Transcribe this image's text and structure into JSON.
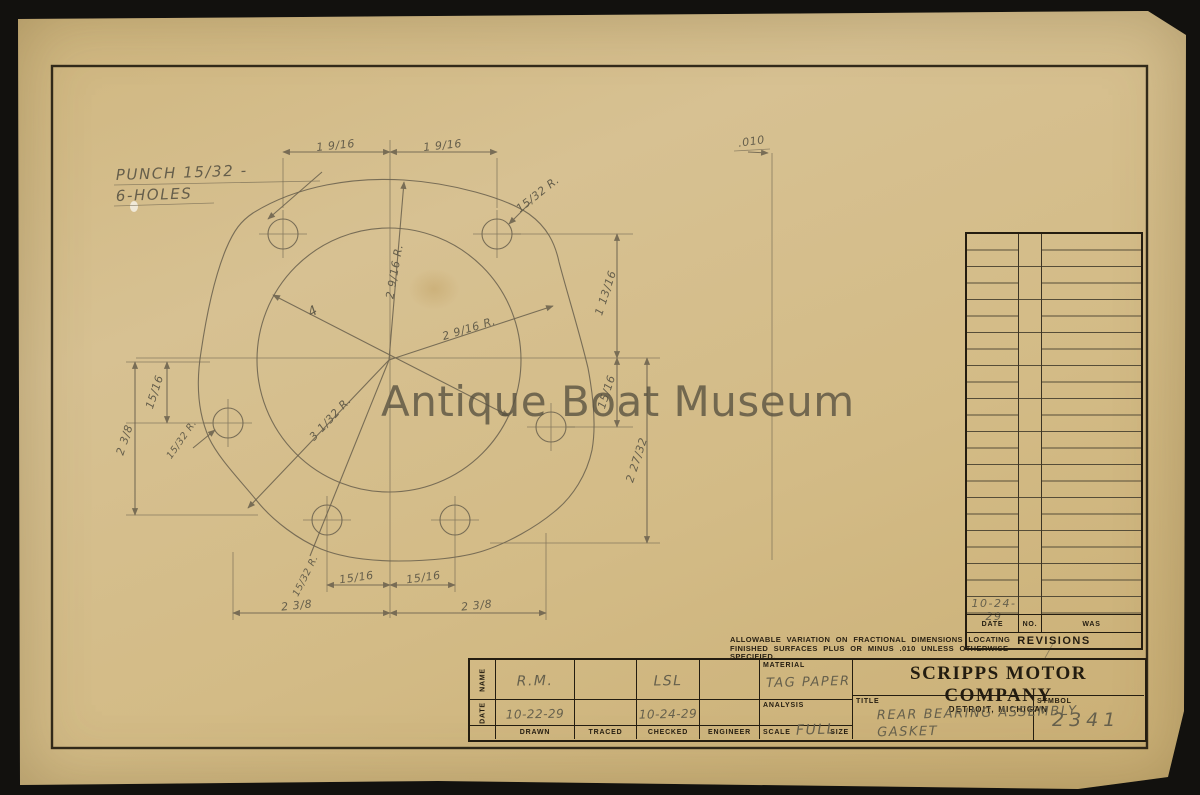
{
  "watermark": "Antique Boat Museum",
  "annotations": {
    "punch_line1": "PUNCH 15/32 -",
    "punch_line2": "6-HOLES",
    "thickness": ".010",
    "dim_top_left": "1 9/16",
    "dim_top_right": "1 9/16",
    "radius_top_right_hole": "15/32 R.",
    "radius_top": "2 9/16 R.",
    "radius_right": "2 9/16 R.",
    "diameter_inner": "4",
    "radius_bottom_left": "3 1/32 R.",
    "radius_left_hole": "15/32 R.",
    "radius_bottom_hole": "15/32 R.",
    "dim_left_upper": "15/16",
    "dim_left_lower": "2 3/8",
    "dim_right_upper": "1 13/16",
    "dim_right_mid": "15/16",
    "dim_right_lower": "2 27/32",
    "dim_bottom_inner_left": "15/16",
    "dim_bottom_inner_right": "15/16",
    "dim_bottom_outer_left": "2 3/8",
    "dim_bottom_outer_right": "2 3/8"
  },
  "tolerance_note": {
    "line1": "ALLOWABLE VARIATION ON FRACTIONAL DIMENSIONS LOCATING",
    "line2": "FINISHED SURFACES PLUS OR MINUS .010 UNLESS OTHERWISE",
    "line3": "SPECIFIED."
  },
  "revisions": {
    "columns": {
      "date": "DATE",
      "no": "NO.",
      "was": "WAS"
    },
    "entry_date": "10-24-29",
    "footer": "REVISIONS"
  },
  "title_block": {
    "name_label": "NAME",
    "date_label": "DATE",
    "drawn_name": "R.M.",
    "traced_name": "",
    "checked_name": "LSL",
    "engineer_name": "",
    "drawn_date": "10-22-29",
    "traced_date": "",
    "checked_date": "10-24-29",
    "engineer_date": "",
    "col_drawn": "DRAWN",
    "col_traced": "TRACED",
    "col_checked": "CHECKED",
    "col_engineer": "ENGINEER",
    "material_label": "MATERIAL",
    "material_value": "TAG PAPER",
    "analysis_label": "ANALYSIS",
    "scale_label": "SCALE",
    "scale_value": "FULL",
    "size_label": "SIZE",
    "company_name": "SCRIPPS MOTOR COMPANY",
    "company_location": "DETROIT, MICHIGAN",
    "title_label": "TITLE",
    "title_line1": "REAR BEARING ASSEMBLY",
    "title_line2": "GASKET",
    "symbol_label": "SYMBOL",
    "symbol_value": "2341"
  }
}
